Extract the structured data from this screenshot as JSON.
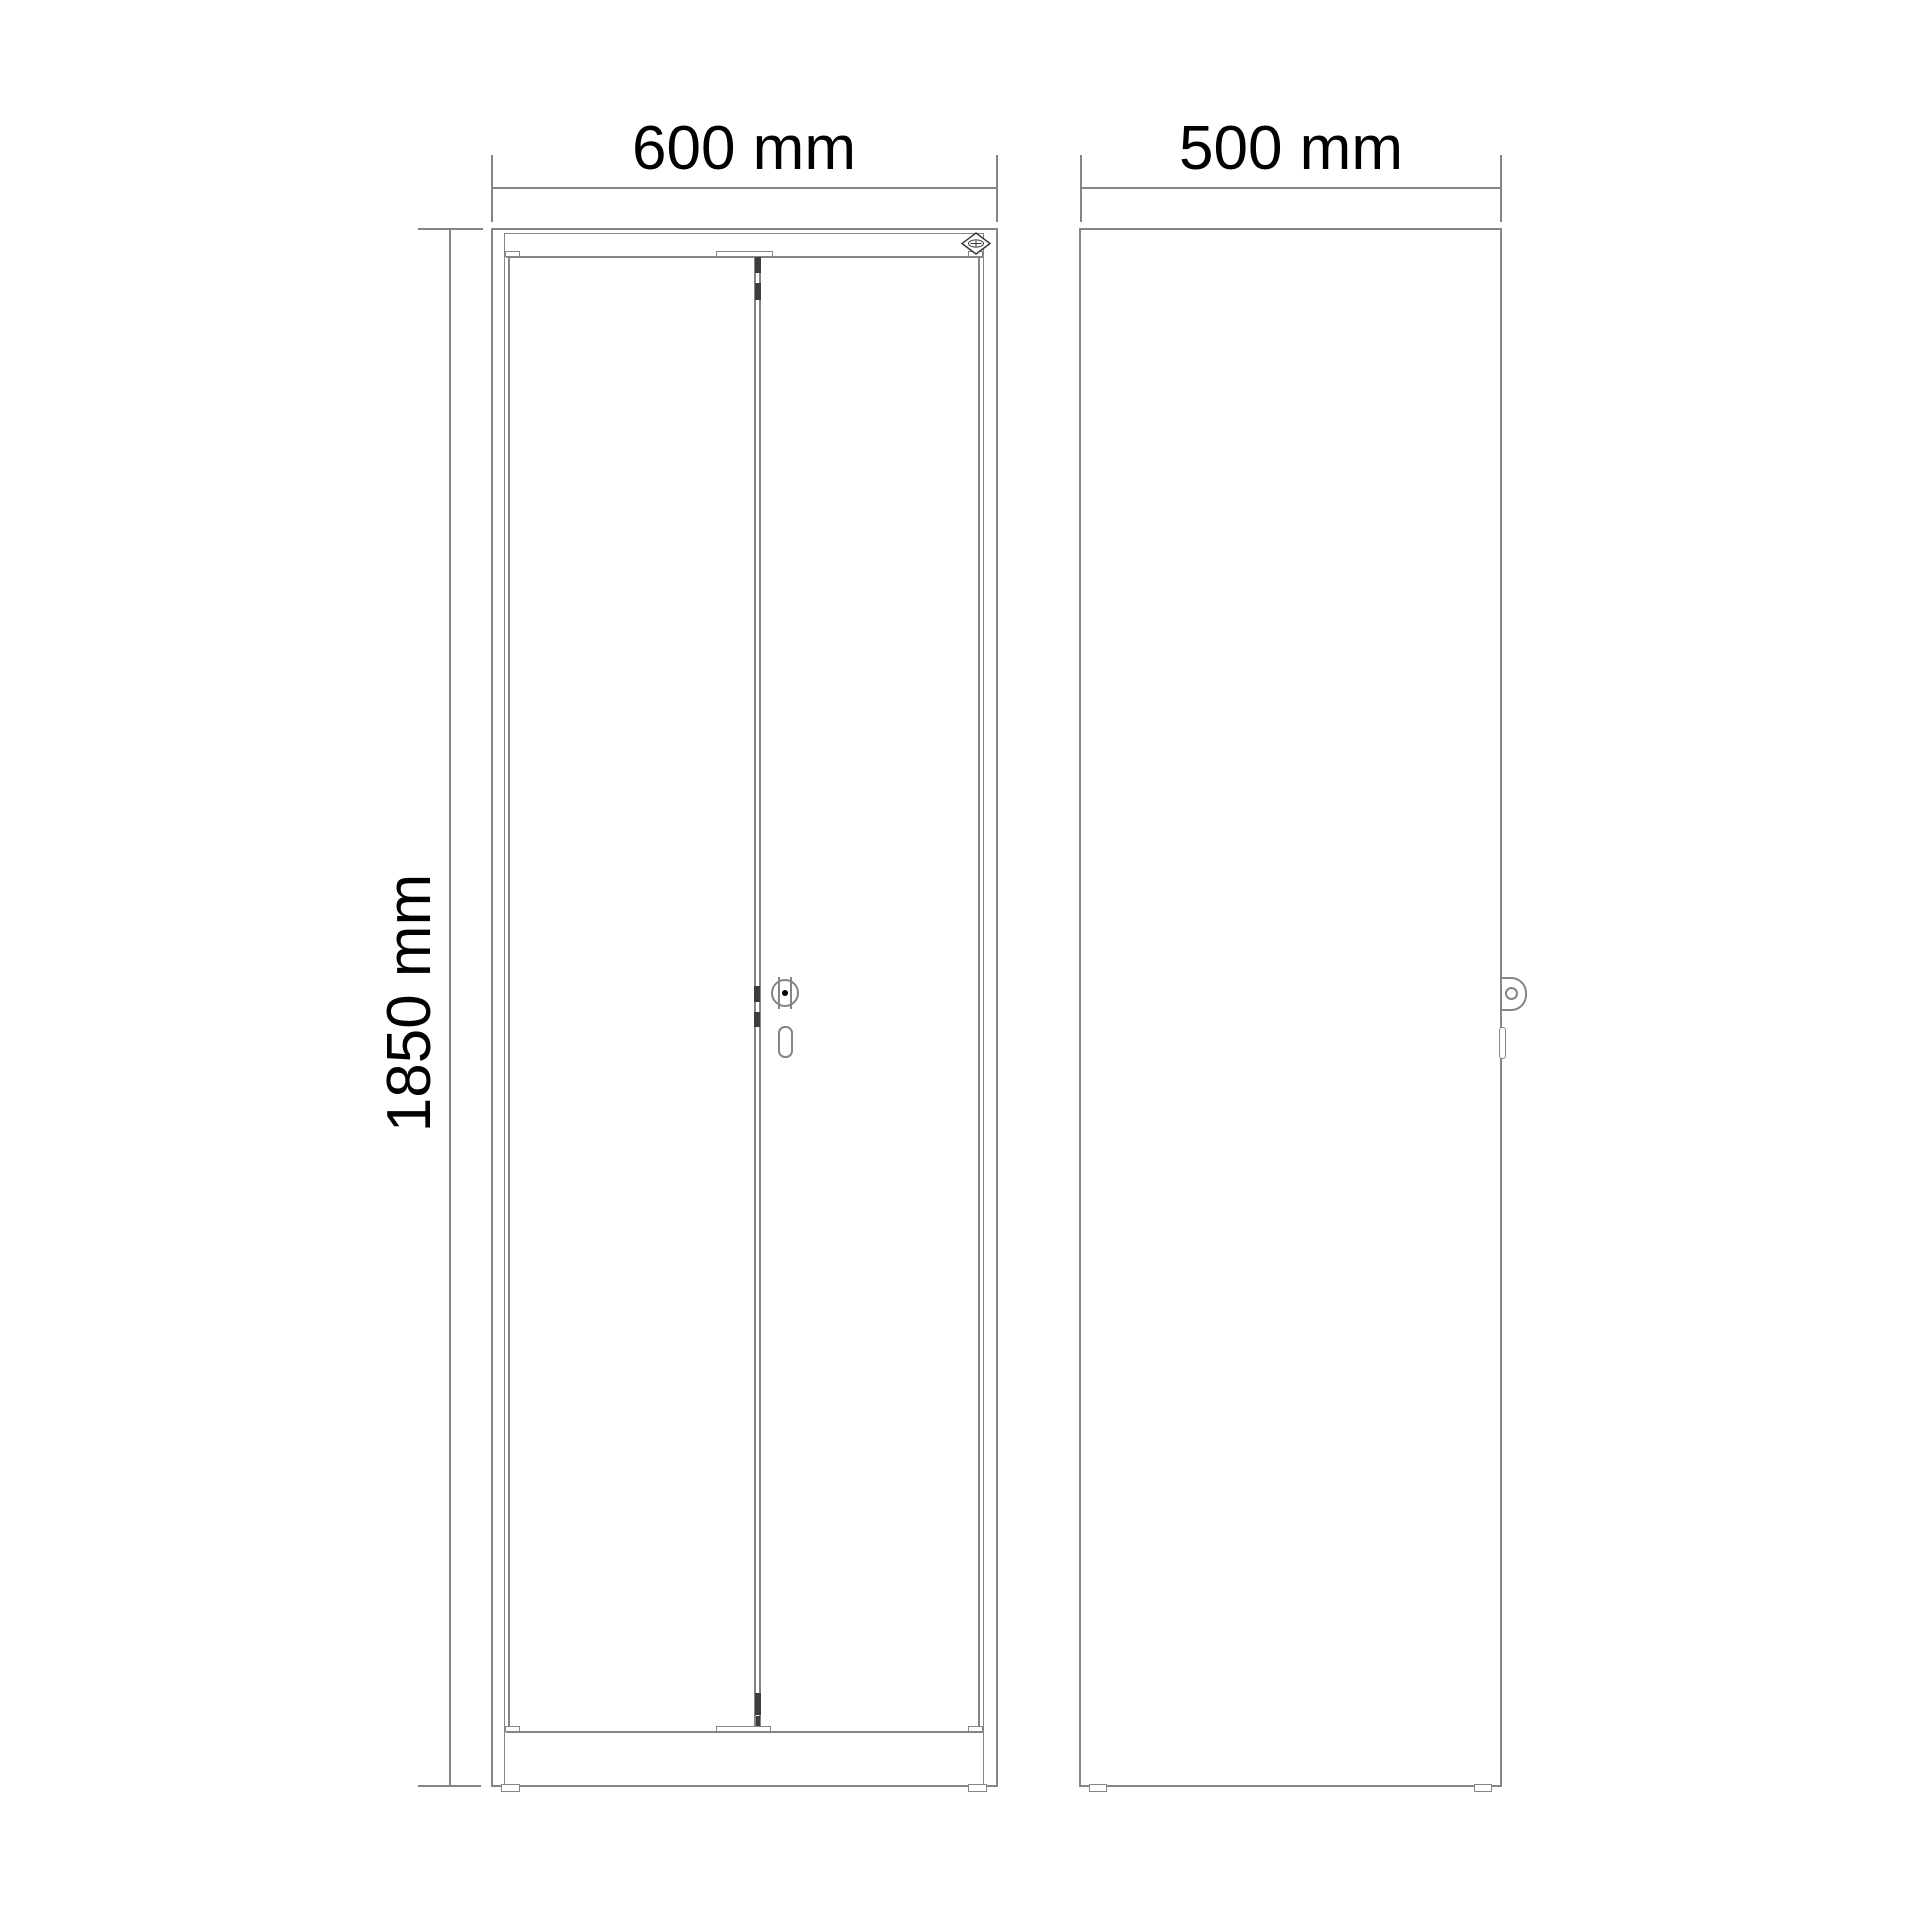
{
  "page": {
    "background": "#ffffff",
    "type": "technical-drawing"
  },
  "colors": {
    "line": "#858585",
    "dark": "#3d3d3d",
    "text": "#000000"
  },
  "dimensions": {
    "front_width": {
      "label": "600 mm"
    },
    "side_width": {
      "label": "500 mm"
    },
    "front_height": {
      "label": "1850 mm"
    }
  },
  "views": {
    "front": {
      "name": "front-view-double-door-cabinet"
    },
    "side": {
      "name": "side-view-cabinet"
    }
  },
  "icons": {
    "logo": "cp-diamond-logo-icon",
    "front_lock": "cylinder-lock-icon",
    "keyhole": "key-slot-icon",
    "side_lock": "lock-knob-icon"
  }
}
